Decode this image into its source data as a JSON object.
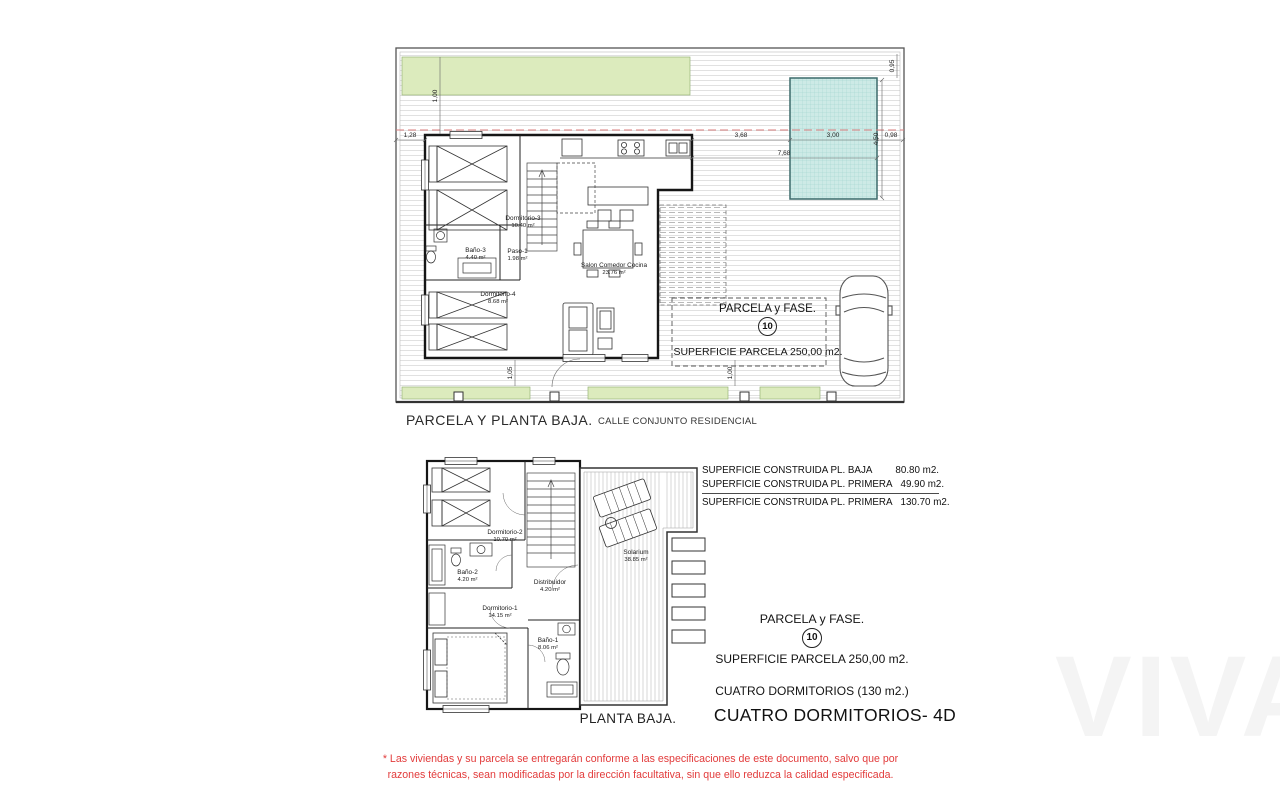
{
  "top_plan": {
    "caption": "PARCELA Y PLANTA BAJA.",
    "street_caption": "CALLE CONJUNTO RESIDENCIAL",
    "parcela_title": "PARCELA y FASE.",
    "parcela_number": "10",
    "parcela_superficie": "SUPERFICIE PARCELA 250,00 m2.",
    "rooms": [
      {
        "name": "Dormitorio-3",
        "area": "10.40 m²"
      },
      {
        "name": "Baño-3",
        "area": "4.40 m²"
      },
      {
        "name": "Paso-1",
        "area": "1.98 m²"
      },
      {
        "name": "Dormitorio-4",
        "area": "8.68 m²"
      },
      {
        "name": "Salon  Comedor  Cocina",
        "area": "23.76 m²"
      }
    ],
    "dims": {
      "left": "1,28",
      "seg1": "3,68",
      "seg2": "3,00",
      "seg3": "0,98",
      "total": "7,68",
      "pool_h": "4,50",
      "pool_top": "0,95",
      "green_depth": "1,00",
      "porch_l": "1,05",
      "porch_r": "1,00"
    }
  },
  "bottom_plan": {
    "caption": "PLANTA BAJA.",
    "rooms": [
      {
        "name": "Dormitorio-2",
        "area": "10.70 m²"
      },
      {
        "name": "Baño-2",
        "area": "4.20 m²"
      },
      {
        "name": "Distribuidor",
        "area": "4.20 m²"
      },
      {
        "name": "Dormitorio-1",
        "area": "14.15 m²"
      },
      {
        "name": "Baño-1",
        "area": "8.06 m²"
      },
      {
        "name": "Solarium",
        "area": "38.85 m²"
      }
    ]
  },
  "summary": {
    "built_areas": [
      {
        "label": "SUPERFICIE CONSTRUIDA PL. BAJA",
        "value": "80.80 m2."
      },
      {
        "label": "SUPERFICIE CONSTRUIDA PL. PRIMERA",
        "value": "49.90 m2."
      },
      {
        "label": "SUPERFICIE CONSTRUIDA PL. PRIMERA",
        "value": "130.70 m2."
      }
    ],
    "parcela_title": "PARCELA y FASE.",
    "parcela_number": "10",
    "parcela_superficie": "SUPERFICIE PARCELA 250,00 m2.",
    "bedrooms_line": "CUATRO DORMITORIOS (130 m2.)",
    "model_line": "CUATRO DORMITORIOS- 4D"
  },
  "footer": {
    "disclaimer": "* Las viviendas y su parcela se entregarán conforme a las especificaciones de este documento, salvo que por razones técnicas, sean modificadas por la dirección facultativa, sin que ello reduzca la calidad especificada."
  },
  "watermark": "VIVA",
  "colors": {
    "garden_green": "#dcebbd",
    "pool_teal": "#cdeae6",
    "setback_red": "#d87c7c",
    "disclaimer_red": "#e23b3b",
    "wall_black": "#161616"
  }
}
